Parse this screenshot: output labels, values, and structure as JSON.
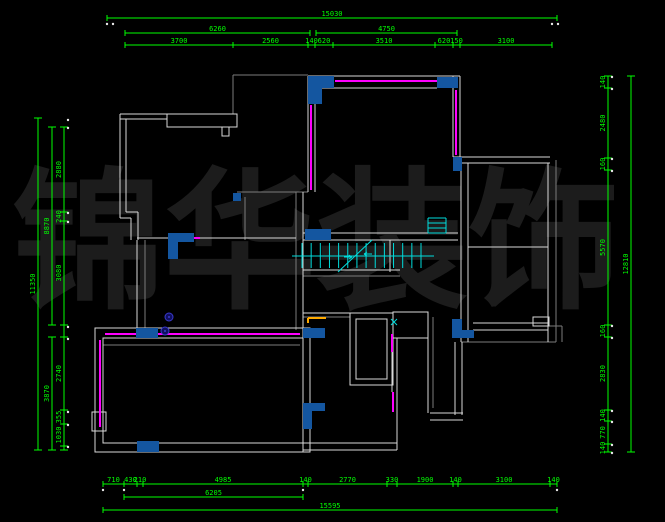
{
  "drawing": {
    "type": "floor-plan-cad",
    "background": "#000000",
    "watermark": {
      "text": "锦华装饰",
      "color": "#1c1c1c"
    }
  },
  "colors": {
    "dim": "#00ff00",
    "wall": "#d9d9d9",
    "wall_gray": "#7b7b7b",
    "accent_magenta": "#ff00ff",
    "fill_blue": "#1456a0",
    "stair_cyan": "#00dddd",
    "orange": "#ffaa00",
    "symbol_blue": "#3a3acc",
    "dot_white": "#e8e8e8"
  },
  "dimensions": {
    "top": {
      "overall": {
        "label": "15030",
        "x1": 107,
        "x2": 557,
        "y": 18
      },
      "level2": [
        {
          "label": "6260",
          "x1": 125,
          "x2": 310,
          "y": 33
        },
        {
          "label": "4750",
          "x1": 316,
          "x2": 457,
          "y": 33
        }
      ],
      "row": {
        "y": 45,
        "ticks": [
          125,
          233,
          308,
          315,
          333,
          435,
          453,
          460,
          552
        ],
        "labels": [
          "3700",
          "2560",
          "140",
          "620",
          "3510",
          "620",
          "150",
          "3100"
        ]
      }
    },
    "bottom": {
      "row1": {
        "y": 484,
        "ticks": [
          103,
          124,
          137,
          143,
          303,
          308,
          387,
          397,
          453,
          458,
          550,
          557
        ],
        "labels": [
          "710",
          "430",
          "210",
          "4985",
          "140",
          "2770",
          "330",
          "1900",
          "140",
          "3100",
          "140"
        ]
      },
      "row2": {
        "label": "6205",
        "x1": 124,
        "x2": 303,
        "y": 497
      },
      "overall": {
        "label": "15595",
        "x1": 103,
        "x2": 557,
        "y": 510
      }
    },
    "left": {
      "overall": {
        "label": "11350",
        "x": 38,
        "y1": 118,
        "y2": 450
      },
      "level2": [
        {
          "label": "8870",
          "x": 52,
          "y1": 127,
          "y2": 325
        },
        {
          "label": "3870",
          "x": 52,
          "y1": 337,
          "y2": 450
        }
      ],
      "row": {
        "x": 64,
        "segments": [
          {
            "label": "2880",
            "y1": 127,
            "y2": 212
          },
          {
            "label": "240",
            "y1": 212,
            "y2": 221
          },
          {
            "label": "3080",
            "y1": 221,
            "y2": 325
          },
          {
            "label": "2740",
            "y1": 337,
            "y2": 410
          },
          {
            "label": "355",
            "y1": 410,
            "y2": 424
          },
          {
            "label": "1030",
            "y1": 424,
            "y2": 446
          },
          {
            "label": "",
            "y1": 446,
            "y2": 450
          }
        ]
      }
    },
    "right": {
      "overall": {
        "label": "12810",
        "x": 631,
        "y1": 76,
        "y2": 452
      },
      "row": {
        "x": 608,
        "segments": [
          {
            "label": "140",
            "y1": 76,
            "y2": 88
          },
          {
            "label": "2480",
            "y1": 88,
            "y2": 158
          },
          {
            "label": "160",
            "y1": 158,
            "y2": 170
          },
          {
            "label": "5570",
            "y1": 170,
            "y2": 325
          },
          {
            "label": "160",
            "y1": 325,
            "y2": 337
          },
          {
            "label": "2830",
            "y1": 337,
            "y2": 410
          },
          {
            "label": "140",
            "y1": 410,
            "y2": 421
          },
          {
            "label": "770",
            "y1": 421,
            "y2": 444
          },
          {
            "label": "140",
            "y1": 444,
            "y2": 452
          }
        ]
      }
    }
  },
  "plan": {
    "white_lines": [
      [
        120,
        114,
        237,
        114
      ],
      [
        120,
        119,
        167,
        119
      ],
      [
        120,
        114,
        120,
        218
      ],
      [
        126,
        119,
        126,
        212
      ],
      [
        126,
        212,
        138,
        212
      ],
      [
        120,
        218,
        131,
        218
      ],
      [
        131,
        218,
        131,
        240
      ],
      [
        138,
        212,
        138,
        240
      ],
      [
        137,
        238,
        296,
        238
      ],
      [
        137,
        240,
        137,
        328
      ],
      [
        308,
        76,
        460,
        76
      ],
      [
        315,
        88,
        437,
        88
      ],
      [
        308,
        76,
        308,
        192
      ],
      [
        315,
        88,
        315,
        192
      ],
      [
        453,
        76,
        453,
        157
      ],
      [
        460,
        76,
        460,
        163
      ],
      [
        303,
        233,
        458,
        233
      ],
      [
        303,
        240,
        458,
        240
      ],
      [
        303,
        192,
        303,
        330
      ],
      [
        303,
        270,
        400,
        270
      ],
      [
        390,
        240,
        390,
        272
      ],
      [
        453,
        157,
        550,
        157
      ],
      [
        453,
        163,
        550,
        163
      ],
      [
        461,
        163,
        461,
        342
      ],
      [
        468,
        163,
        468,
        342
      ],
      [
        548,
        163,
        548,
        342
      ],
      [
        468,
        247,
        548,
        247
      ],
      [
        473,
        323,
        548,
        323
      ],
      [
        473,
        330,
        548,
        330
      ],
      [
        455,
        342,
        455,
        415
      ],
      [
        462,
        342,
        462,
        415
      ],
      [
        430,
        413,
        463,
        413
      ],
      [
        430,
        420,
        463,
        420
      ],
      [
        303,
        313,
        393,
        313
      ],
      [
        428,
        312,
        428,
        413
      ],
      [
        397,
        338,
        397,
        450
      ],
      [
        392,
        352,
        392,
        392
      ],
      [
        303,
        443,
        397,
        443
      ],
      [
        303,
        450,
        397,
        450
      ],
      [
        303,
        328,
        303,
        452
      ],
      [
        310,
        328,
        310,
        452
      ]
    ],
    "white_rects": [
      [
        167,
        114,
        70,
        13
      ],
      [
        222,
        127,
        7,
        9
      ],
      [
        95,
        328,
        215,
        124
      ],
      [
        103,
        338,
        200,
        105
      ],
      [
        92,
        412,
        14,
        19
      ],
      [
        350,
        313,
        43,
        72
      ],
      [
        356,
        319,
        31,
        60
      ],
      [
        393,
        312,
        35,
        26
      ],
      [
        533,
        317,
        16,
        9
      ]
    ],
    "gray_lines": [
      [
        233,
        75,
        233,
        114
      ],
      [
        233,
        75,
        308,
        75
      ],
      [
        237,
        192,
        308,
        192
      ],
      [
        245,
        197,
        245,
        240
      ],
      [
        296,
        192,
        296,
        330
      ],
      [
        145,
        240,
        145,
        328
      ],
      [
        556,
        160,
        556,
        342
      ],
      [
        548,
        326,
        562,
        326
      ],
      [
        562,
        326,
        562,
        342
      ],
      [
        303,
        276,
        400,
        276
      ],
      [
        303,
        317,
        350,
        317
      ],
      [
        433,
        317,
        433,
        408
      ],
      [
        103,
        345,
        300,
        345
      ],
      [
        461,
        342,
        556,
        342
      ]
    ],
    "magenta_lines": [
      [
        335,
        81,
        437,
        81
      ],
      [
        311,
        105,
        311,
        190
      ],
      [
        456,
        90,
        456,
        155
      ],
      [
        182,
        238,
        200,
        238
      ],
      [
        100,
        340,
        100,
        427
      ],
      [
        105,
        334,
        136,
        334
      ],
      [
        158,
        334,
        300,
        334
      ],
      [
        392,
        334,
        392,
        352
      ],
      [
        393,
        392,
        393,
        412
      ]
    ],
    "orange_lines": [
      [
        308,
        318,
        308,
        323
      ],
      [
        308,
        318,
        326,
        318
      ]
    ],
    "cyan_lines": [
      [
        428,
        218,
        446,
        218
      ],
      [
        428,
        233,
        446,
        233
      ],
      [
        428,
        218,
        428,
        233
      ],
      [
        446,
        218,
        446,
        233
      ],
      [
        428,
        223,
        446,
        223
      ],
      [
        428,
        228,
        446,
        228
      ],
      [
        391,
        319,
        397,
        325
      ],
      [
        397,
        319,
        391,
        325
      ],
      [
        344,
        257,
        352,
        257
      ],
      [
        349,
        255,
        352,
        257
      ],
      [
        349,
        259,
        352,
        257
      ],
      [
        372,
        254,
        364,
        254
      ],
      [
        367,
        252,
        364,
        254
      ],
      [
        367,
        256,
        364,
        254
      ]
    ],
    "blue_fills": [
      [
        308,
        76,
        26,
        12
      ],
      [
        308,
        88,
        14,
        16
      ],
      [
        437,
        77,
        21,
        11
      ],
      [
        453,
        157,
        9,
        14
      ],
      [
        305,
        229,
        26,
        11
      ],
      [
        168,
        233,
        26,
        9
      ],
      [
        168,
        233,
        10,
        26
      ],
      [
        136,
        328,
        22,
        10
      ],
      [
        303,
        328,
        22,
        10
      ],
      [
        137,
        441,
        22,
        11
      ],
      [
        303,
        403,
        22,
        8
      ],
      [
        303,
        408,
        9,
        21
      ],
      [
        452,
        319,
        10,
        19
      ],
      [
        452,
        330,
        22,
        8
      ],
      [
        233,
        193,
        8,
        8
      ]
    ],
    "symbol_circles": [
      [
        169,
        317,
        4
      ],
      [
        165,
        331,
        4
      ]
    ],
    "stairs": {
      "x1": 302,
      "x2": 421,
      "treads": 13,
      "y1": 243,
      "y2": 268,
      "rail": [
        292,
        256,
        434,
        256
      ],
      "break_line": [
        338,
        272,
        372,
        240
      ]
    },
    "white_dots": [
      [
        107,
        24
      ],
      [
        113,
        24
      ],
      [
        552,
        24
      ],
      [
        558,
        24
      ],
      [
        68,
        120
      ],
      [
        68,
        128
      ],
      [
        68,
        213
      ],
      [
        68,
        222
      ],
      [
        68,
        327
      ],
      [
        68,
        339
      ],
      [
        68,
        412
      ],
      [
        68,
        425
      ],
      [
        68,
        447
      ],
      [
        103,
        490
      ],
      [
        124,
        490
      ],
      [
        303,
        490
      ],
      [
        557,
        490
      ],
      [
        612,
        77
      ],
      [
        612,
        89
      ],
      [
        612,
        159
      ],
      [
        612,
        171
      ],
      [
        612,
        326
      ],
      [
        612,
        338
      ],
      [
        612,
        411
      ],
      [
        612,
        422
      ],
      [
        612,
        445
      ],
      [
        612,
        453
      ]
    ]
  }
}
